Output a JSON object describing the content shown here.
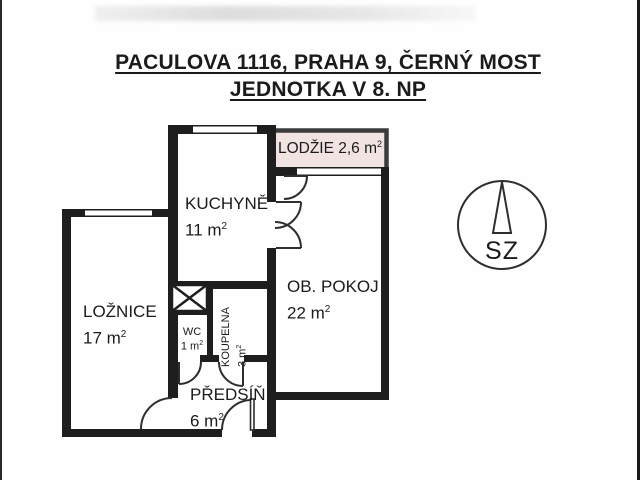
{
  "title": {
    "line1": "PACULOVA 1116, PRAHA 9, ČERNÝ MOST",
    "line2": "JEDNOTKA V 8. NP"
  },
  "rooms": {
    "lodzie": {
      "label": "LODŽIE 2,6 m",
      "sup": "2"
    },
    "kuchyne": {
      "name": "KUCHYNĚ",
      "area": "11 m",
      "sup": "2"
    },
    "ob_pokoj": {
      "name": "OB. POKOJ",
      "area": "22 m",
      "sup": "2"
    },
    "loznice": {
      "name": "LOŽNICE",
      "area": "17 m",
      "sup": "2"
    },
    "wc": {
      "name": "WC",
      "area": "1 m",
      "sup": "2"
    },
    "koupelna": {
      "name": "KOUPELNA",
      "area": "3 m",
      "sup": "2"
    },
    "predsin": {
      "name": "PŘEDSÍŇ",
      "area": "6 m",
      "sup": "2"
    }
  },
  "compass": {
    "label": "SZ"
  },
  "colors": {
    "wall": "#1e1e1e",
    "door_line": "#2e2e2e",
    "lodzie_fill": "#f2e3e3",
    "lodzie_border": "#3c3c3c",
    "background": "#fefefe"
  }
}
